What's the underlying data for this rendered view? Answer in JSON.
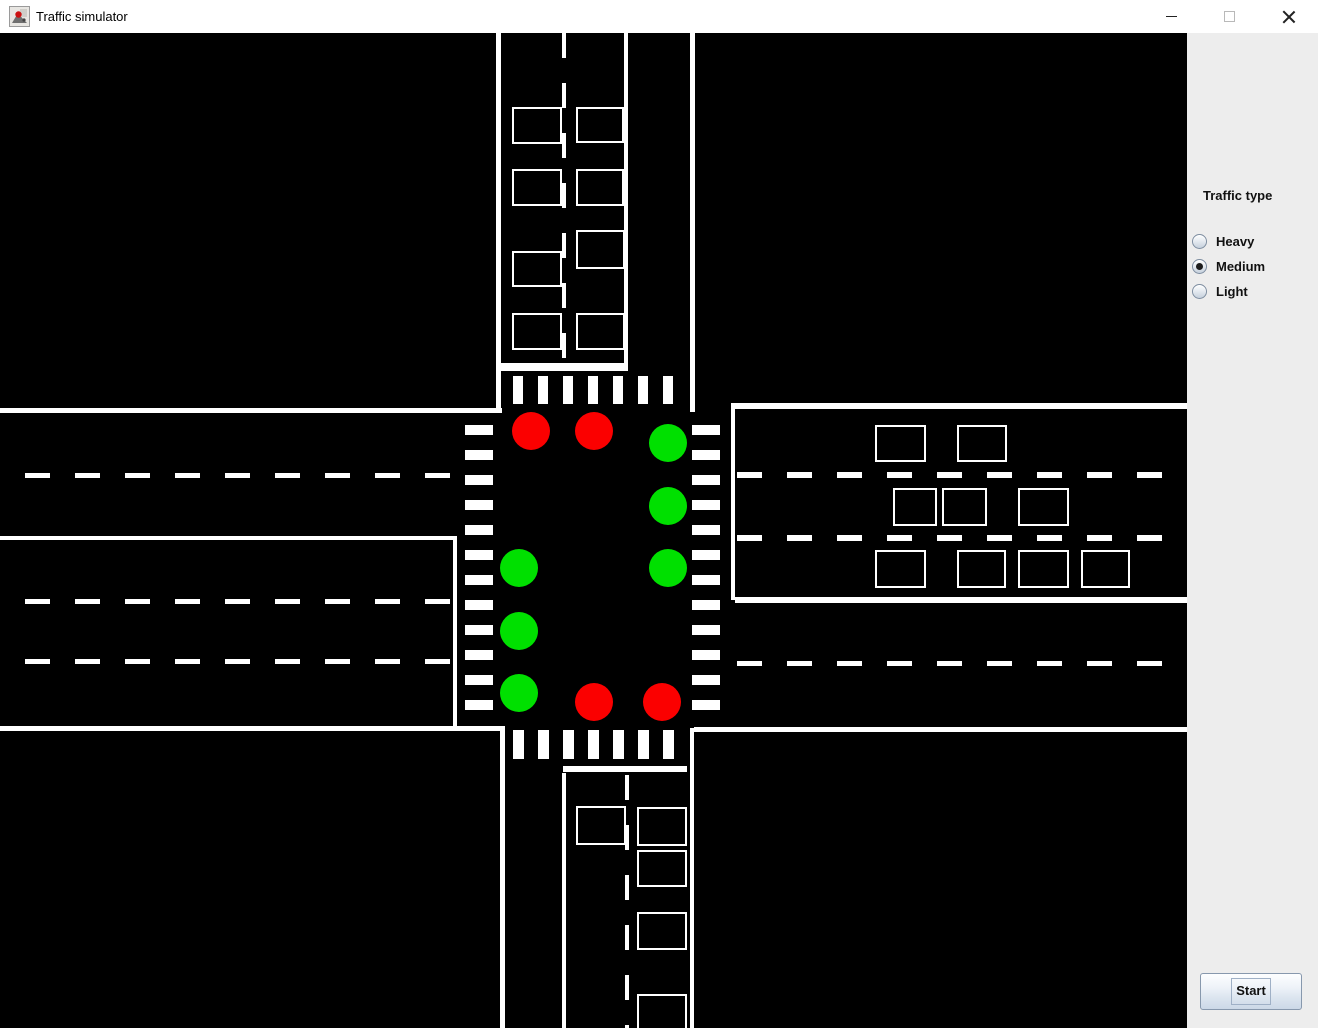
{
  "window": {
    "title": "Traffic simulator",
    "icons": [
      "app-icon",
      "minimize-icon",
      "maximize-icon",
      "close-icon"
    ]
  },
  "panel": {
    "traffic_type_label": "Traffic type",
    "options": [
      {
        "label": "Heavy",
        "selected": false
      },
      {
        "label": "Medium",
        "selected": true
      },
      {
        "label": "Light",
        "selected": false
      }
    ],
    "start_label": "Start",
    "bg_color": "#ededed"
  },
  "colors": {
    "canvas_bg": "#000000",
    "road_marking": "#ffffff",
    "red_light": "#fb0000",
    "green_light": "#00e000"
  },
  "canvas": {
    "items": [
      {
        "type": "line",
        "name": "top-road-left-edge",
        "x": 496,
        "y": 0,
        "w": 5,
        "h": 380
      },
      {
        "type": "line",
        "name": "top-road-median-line",
        "x": 624,
        "y": 0,
        "w": 4,
        "h": 338
      },
      {
        "type": "line",
        "name": "top-road-right-edge",
        "x": 690,
        "y": 0,
        "w": 5,
        "h": 379
      },
      {
        "type": "line",
        "name": "top-stop-line",
        "x": 500,
        "y": 330,
        "w": 128,
        "h": 8
      },
      {
        "type": "line",
        "name": "left-road-top-edge",
        "x": 0,
        "y": 375,
        "w": 502,
        "h": 5
      },
      {
        "type": "line",
        "name": "left-road-median-line",
        "x": 0,
        "y": 503,
        "w": 457,
        "h": 4
      },
      {
        "type": "line",
        "name": "left-road-right-edge",
        "x": 453,
        "y": 503,
        "w": 4,
        "h": 195
      },
      {
        "type": "line",
        "name": "left-road-bottom-edge",
        "x": 0,
        "y": 693,
        "w": 502,
        "h": 5
      },
      {
        "type": "line",
        "name": "right-road-top-edge",
        "x": 731,
        "y": 370,
        "w": 456,
        "h": 6
      },
      {
        "type": "line",
        "name": "right-road-left-edge",
        "x": 731,
        "y": 370,
        "w": 4,
        "h": 197
      },
      {
        "type": "line",
        "name": "right-road-median-line",
        "x": 735,
        "y": 564,
        "w": 452,
        "h": 6
      },
      {
        "type": "line",
        "name": "right-road-bottom-edge",
        "x": 694,
        "y": 694,
        "w": 493,
        "h": 5
      },
      {
        "type": "line",
        "name": "bottom-road-left-edge",
        "x": 500,
        "y": 693,
        "w": 5,
        "h": 302
      },
      {
        "type": "line",
        "name": "bottom-road-median-line",
        "x": 562,
        "y": 740,
        "w": 4,
        "h": 255
      },
      {
        "type": "line",
        "name": "bottom-road-right-edge",
        "x": 690,
        "y": 695,
        "w": 4,
        "h": 300
      },
      {
        "type": "line",
        "name": "bottom-stop-line",
        "x": 563,
        "y": 733,
        "w": 124,
        "h": 6
      },
      {
        "type": "stripes-h",
        "name": "crosswalk-top",
        "x": 513,
        "y": 343,
        "w": 10,
        "h": 28,
        "count": 7,
        "step": 25
      },
      {
        "type": "stripes-h",
        "name": "crosswalk-bottom",
        "x": 513,
        "y": 697,
        "w": 11,
        "h": 29,
        "count": 7,
        "step": 25
      },
      {
        "type": "stripes-v",
        "name": "crosswalk-left",
        "x": 465,
        "y": 392,
        "w": 28,
        "h": 10,
        "count": 12,
        "step": 25
      },
      {
        "type": "stripes-v",
        "name": "crosswalk-right",
        "x": 692,
        "y": 392,
        "w": 28,
        "h": 10,
        "count": 12,
        "step": 25
      },
      {
        "type": "dash-v",
        "name": "top-road-lane-dashes",
        "x": 562,
        "y": 0,
        "w": 4,
        "h": 331
      },
      {
        "type": "dash-h",
        "name": "left-road-upper-lane-dashes",
        "x": 25,
        "y": 440,
        "w": 426,
        "h": 5
      },
      {
        "type": "dash-h",
        "name": "left-road-mid-lane-dashes",
        "x": 25,
        "y": 566,
        "w": 427,
        "h": 5
      },
      {
        "type": "dash-h",
        "name": "left-road-lower-lane-dashes",
        "x": 25,
        "y": 626,
        "w": 427,
        "h": 5
      },
      {
        "type": "dash-h",
        "name": "right-road-lane1-dashes",
        "x": 737,
        "y": 439,
        "w": 450,
        "h": 6
      },
      {
        "type": "dash-h",
        "name": "right-road-lane2-dashes",
        "x": 737,
        "y": 502,
        "w": 450,
        "h": 6
      },
      {
        "type": "dash-h",
        "name": "right-road-lower-lane-dashes",
        "x": 737,
        "y": 628,
        "w": 426,
        "h": 5
      },
      {
        "type": "dash-v",
        "name": "bottom-road-lane-dashes",
        "x": 625,
        "y": 742,
        "w": 4,
        "h": 253
      },
      {
        "type": "car",
        "x": 512,
        "y": 74,
        "w": 50,
        "h": 37
      },
      {
        "type": "car",
        "x": 576,
        "y": 74,
        "w": 48,
        "h": 36
      },
      {
        "type": "car",
        "x": 512,
        "y": 136,
        "w": 50,
        "h": 37
      },
      {
        "type": "car",
        "x": 576,
        "y": 136,
        "w": 48,
        "h": 37
      },
      {
        "type": "car",
        "x": 576,
        "y": 197,
        "w": 49,
        "h": 39
      },
      {
        "type": "car",
        "x": 512,
        "y": 218,
        "w": 50,
        "h": 36
      },
      {
        "type": "car",
        "x": 512,
        "y": 280,
        "w": 50,
        "h": 37
      },
      {
        "type": "car",
        "x": 576,
        "y": 280,
        "w": 49,
        "h": 37
      },
      {
        "type": "car",
        "x": 875,
        "y": 392,
        "w": 51,
        "h": 37
      },
      {
        "type": "car",
        "x": 957,
        "y": 392,
        "w": 50,
        "h": 37
      },
      {
        "type": "car",
        "x": 893,
        "y": 455,
        "w": 44,
        "h": 38
      },
      {
        "type": "car",
        "x": 942,
        "y": 455,
        "w": 45,
        "h": 38
      },
      {
        "type": "car",
        "x": 1018,
        "y": 455,
        "w": 51,
        "h": 38
      },
      {
        "type": "car",
        "x": 875,
        "y": 517,
        "w": 51,
        "h": 38
      },
      {
        "type": "car",
        "x": 957,
        "y": 517,
        "w": 49,
        "h": 38
      },
      {
        "type": "car",
        "x": 1018,
        "y": 517,
        "w": 51,
        "h": 38
      },
      {
        "type": "car",
        "x": 1081,
        "y": 517,
        "w": 49,
        "h": 38
      },
      {
        "type": "car",
        "x": 576,
        "y": 773,
        "w": 50,
        "h": 39
      },
      {
        "type": "car",
        "x": 637,
        "y": 774,
        "w": 50,
        "h": 39
      },
      {
        "type": "car",
        "x": 637,
        "y": 817,
        "w": 50,
        "h": 37
      },
      {
        "type": "car",
        "x": 637,
        "y": 879,
        "w": 50,
        "h": 38
      },
      {
        "type": "car",
        "x": 637,
        "y": 961,
        "w": 50,
        "h": 38
      },
      {
        "type": "light",
        "cx": 531,
        "cy": 398,
        "r": 19,
        "state": "red"
      },
      {
        "type": "light",
        "cx": 594,
        "cy": 398,
        "r": 19,
        "state": "red"
      },
      {
        "type": "light",
        "cx": 668,
        "cy": 410,
        "r": 19,
        "state": "green"
      },
      {
        "type": "light",
        "cx": 668,
        "cy": 473,
        "r": 19,
        "state": "green"
      },
      {
        "type": "light",
        "cx": 668,
        "cy": 535,
        "r": 19,
        "state": "green"
      },
      {
        "type": "light",
        "cx": 519,
        "cy": 535,
        "r": 19,
        "state": "green"
      },
      {
        "type": "light",
        "cx": 519,
        "cy": 598,
        "r": 19,
        "state": "green"
      },
      {
        "type": "light",
        "cx": 519,
        "cy": 660,
        "r": 19,
        "state": "green"
      },
      {
        "type": "light",
        "cx": 594,
        "cy": 669,
        "r": 19,
        "state": "red"
      },
      {
        "type": "light",
        "cx": 662,
        "cy": 669,
        "r": 19,
        "state": "red"
      }
    ]
  }
}
